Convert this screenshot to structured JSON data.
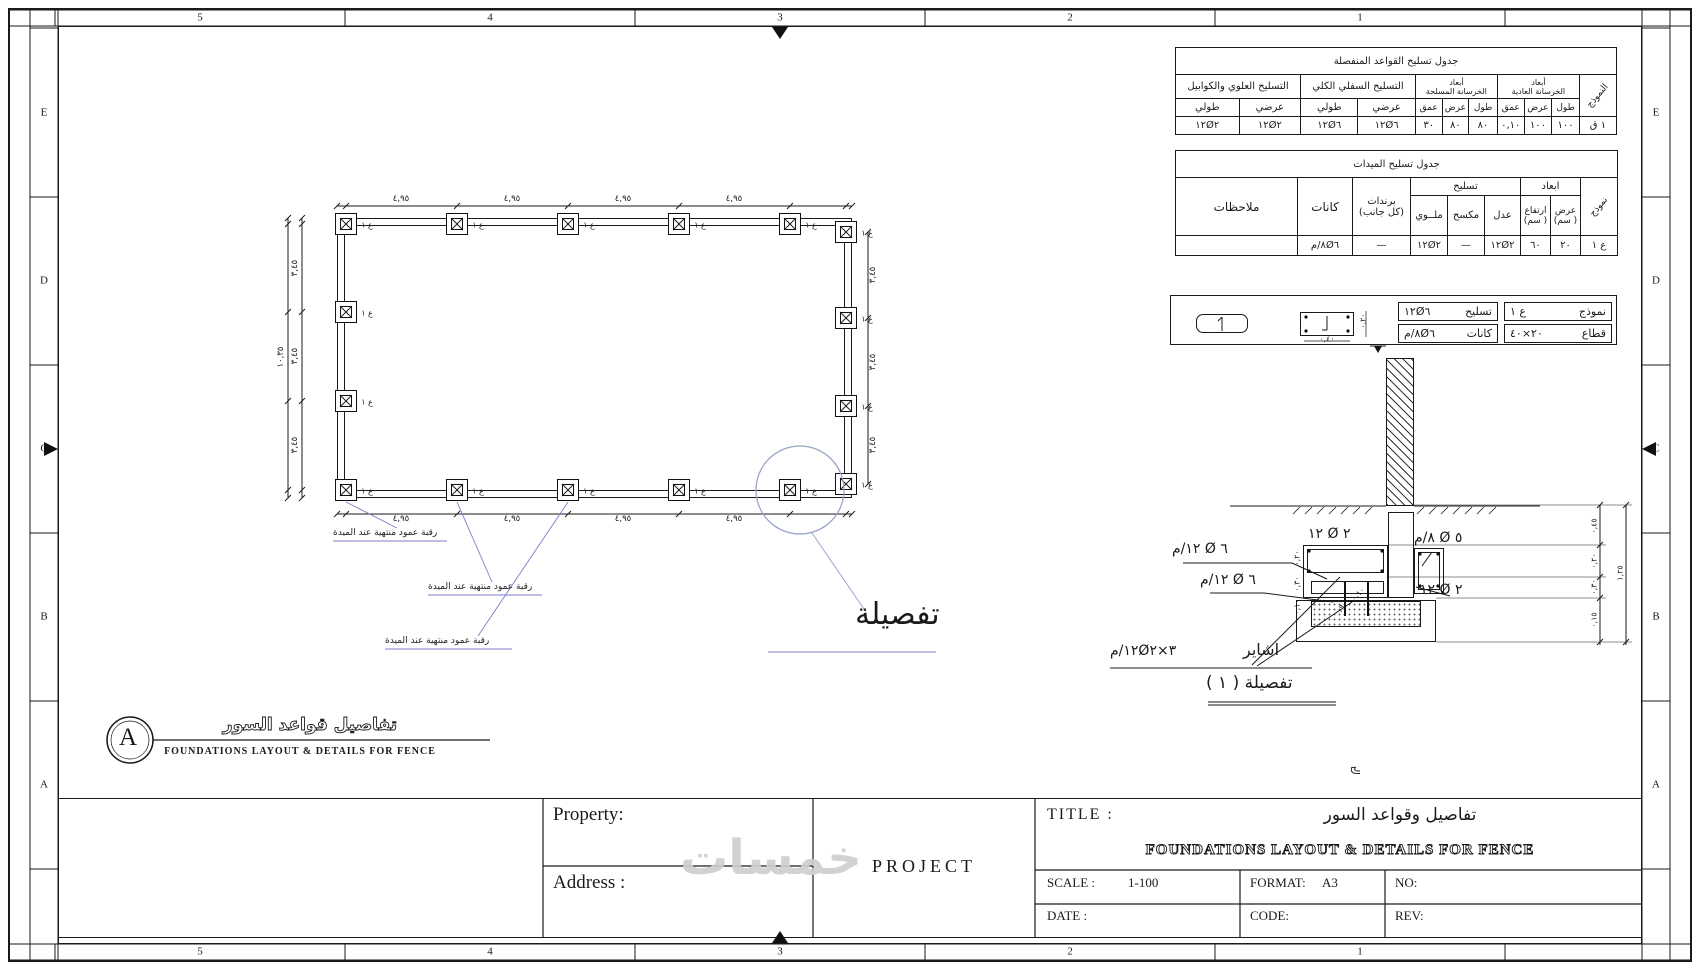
{
  "frame": {
    "top_numbers": [
      "5",
      "4",
      "3",
      "2",
      "1"
    ],
    "side_letters": [
      "E",
      "D",
      "C",
      "B",
      "A"
    ]
  },
  "t1": {
    "title": "جدول تسليح القواعد المنفصلة",
    "g_upper": "التسليح العلوي والكوابيل",
    "g_lower": "التسليح السفلي الكلي",
    "g_rc": "أبعاد\nالخرسانة المسلحة",
    "g_pc": "أبعاد\nالخرسانة العادية",
    "g_model": "النموذج",
    "h_long": "طولي",
    "h_cross": "عرضي",
    "h_depth": "عمق",
    "h_width": "عرض",
    "h_len": "طول",
    "v": [
      "١٢Ø٢",
      "١٢Ø٢",
      "١٢Ø٦",
      "١٢Ø٦",
      "٣٠",
      "٨٠",
      "٨٠",
      "٠,١٠",
      "١٠٠",
      "١٠٠",
      "ق ١"
    ]
  },
  "t2": {
    "title": "جدول تسليح الميدات",
    "h_notes": "ملاحظات",
    "h_stirrups": "كانات",
    "h_side": "برندات\n(كل جانب)",
    "g_reinf": "تسليح",
    "g_dims": "ابعاد",
    "h_bent2": "ملــوي",
    "h_bent": "مكسح",
    "h_straight": "عدل",
    "h_height": "ارتفاع\n( سم)",
    "h_width": "عرض\n( سم)",
    "g_model": "نموذج",
    "v": [
      "",
      "م/٨Ø٦",
      "—",
      "١٢Ø٢",
      "—",
      "١٢Ø٢",
      "٦٠",
      "٢٠",
      "١ ع"
    ]
  },
  "mbox": {
    "k_model": "نموذج",
    "v_model": "١ ع",
    "k_reinf": "تسليح",
    "v_reinf": "١٢Ø٦",
    "k_stir": "كانات",
    "v_stir": "م/٨Ø٦",
    "k_sec": "قطاع",
    "v_sec": "٤٠×٢٠"
  },
  "plan": {
    "footing_label": "١ ع",
    "footings": [
      [
        346,
        224
      ],
      [
        457,
        224
      ],
      [
        568,
        224
      ],
      [
        679,
        224
      ],
      [
        790,
        224
      ],
      [
        846,
        232
      ],
      [
        846,
        318
      ],
      [
        846,
        406
      ],
      [
        846,
        484
      ],
      [
        790,
        490
      ],
      [
        679,
        490
      ],
      [
        568,
        490
      ],
      [
        457,
        490
      ],
      [
        346,
        490
      ],
      [
        346,
        312
      ],
      [
        346,
        401
      ]
    ],
    "dim_labels": [
      {
        "t": "٤,٩٥",
        "x": 401,
        "y": 200
      },
      {
        "t": "٤,٩٥",
        "x": 512,
        "y": 200
      },
      {
        "t": "٤,٩٥",
        "x": 623,
        "y": 200
      },
      {
        "t": "٤,٩٥",
        "x": 734,
        "y": 200
      },
      {
        "t": "٤,٩٥",
        "x": 401,
        "y": 520
      },
      {
        "t": "٤,٩٥",
        "x": 512,
        "y": 520
      },
      {
        "t": "٤,٩٥",
        "x": 623,
        "y": 520
      },
      {
        "t": "٤,٩٥",
        "x": 734,
        "y": 520
      },
      {
        "t": "٣,٤٥",
        "x": 296,
        "y": 268,
        "r": 1
      },
      {
        "t": "٣,٤٥",
        "x": 296,
        "y": 356,
        "r": 1
      },
      {
        "t": "٣,٤٥",
        "x": 296,
        "y": 445,
        "r": 1
      },
      {
        "t": "١٠,٣٥",
        "x": 282,
        "y": 357,
        "r": 1
      },
      {
        "t": "٣,٤٥",
        "x": 874,
        "y": 275,
        "r": 1
      },
      {
        "t": "٣,٤٥",
        "x": 874,
        "y": 362,
        "r": 1
      },
      {
        "t": "٣,٤٥",
        "x": 874,
        "y": 445,
        "r": 1
      }
    ],
    "callout": "رقبة عمود منتهية عند الميدة",
    "callouts": [
      [
        333,
        528
      ],
      [
        428,
        582
      ],
      [
        385,
        636
      ]
    ],
    "detail_word": "تفصيلة"
  },
  "detail": {
    "labels": [
      {
        "t": "١٢ Ø ٢",
        "x": 1308,
        "y": 526
      },
      {
        "t": "م/١٢ Ø ٦",
        "x": 1172,
        "y": 541
      },
      {
        "t": "م/١٢ Ø ٦",
        "x": 1200,
        "y": 572
      },
      {
        "t": "م/٨ Ø ٥",
        "x": 1414,
        "y": 530
      },
      {
        "t": "١٢ Ø ٢",
        "x": 1420,
        "y": 582
      },
      {
        "t": "م/١٢Ø٢×٣",
        "x": 1110,
        "y": 643
      }
    ],
    "rebar_word": "اشاير",
    "caption": "تفصيلة ( ١ )",
    "dim_labels": [
      {
        "t": "٠,٤٥",
        "x": 1594,
        "y": 526,
        "r": 1
      },
      {
        "t": "٠,٢٠",
        "x": 1594,
        "y": 561,
        "r": 1
      },
      {
        "t": "٠,٣٠",
        "x": 1594,
        "y": 587,
        "r": 1
      },
      {
        "t": "٠,١٥",
        "x": 1594,
        "y": 620,
        "r": 1
      },
      {
        "t": "١,٢٥",
        "x": 1620,
        "y": 573,
        "r": 1
      },
      {
        "t": "٠,٢٠",
        "x": 1297,
        "y": 558,
        "r": 1
      },
      {
        "t": "٠,٣٠",
        "x": 1297,
        "y": 584,
        "r": 1
      },
      {
        "t": "٠,١٠",
        "x": 1297,
        "y": 607,
        "r": 1
      },
      {
        "t": "٠,١٠",
        "x": 1358,
        "y": 594,
        "r": 2
      },
      {
        "t": "٠,٩٠",
        "x": 1341,
        "y": 608,
        "r": 2
      },
      {
        "t": "٠,٤٠",
        "x": 1327,
        "y": 339
      },
      {
        "t": "٠,٢٠",
        "x": 1363,
        "y": 321,
        "r": 1
      }
    ]
  },
  "note": "× لا يتم ربط قواعد السور بالقواعد بامنشا الاساسى",
  "header_a": {
    "bubble": "A",
    "title_ar": "تفاصيل قواعد السور",
    "title_en": "FOUNDATIONS LAYOUT & DETAILS FOR FENCE"
  },
  "tb": {
    "property": "Property:",
    "address": "Address :",
    "project": "PROJECT",
    "title_label": "TITLE :",
    "title_ar": "تفاصيل وقواعد السور",
    "title_en": "FOUNDATIONS LAYOUT & DETAILS FOR FENCE",
    "scale_l": "SCALE :",
    "scale_v": "1-100",
    "format_l": "FORMAT:",
    "format_v": "A3",
    "no_l": "NO:",
    "date_l": "DATE :",
    "code_l": "CODE:",
    "rev_l": "REV:"
  },
  "watermark": "خمسات"
}
